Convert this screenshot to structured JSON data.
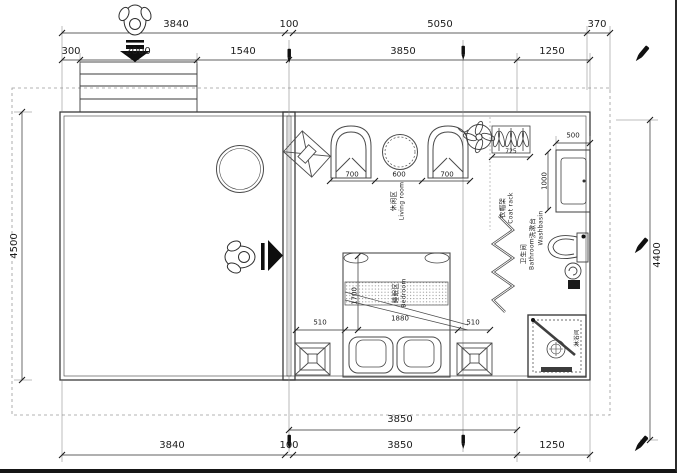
{
  "drawing_title": "guest-room floor plan",
  "dims": {
    "top1": [
      "3840",
      "100",
      "5050",
      "370"
    ],
    "top2": [
      "300",
      "2000",
      "1540",
      "3850",
      "1250"
    ],
    "left": "4500",
    "right": "4400",
    "living": [
      "700",
      "600",
      "700"
    ],
    "coat_rack_w": "725",
    "washbasin_w": "500",
    "washbasin_h": "1000",
    "bed_row": [
      "510",
      "1880",
      "510"
    ],
    "bed_len": "1700",
    "bottom1": "3850",
    "bottom2": [
      "3840",
      "100",
      "3850",
      "1250"
    ]
  },
  "labels": {
    "living": {
      "zh": "休闲区",
      "en": "Living room"
    },
    "bedroom": {
      "zh": "睡眠区",
      "en": "Bedroom"
    },
    "bathroom": {
      "zh": "卫生间",
      "en": "Bathroom"
    },
    "coat_rack": {
      "zh": "衣帽架",
      "en": "Coat rack"
    },
    "washbasin": {
      "zh": "洗漱台",
      "en": "Washbasin"
    },
    "shower": {
      "zh": "淋浴间",
      "en": ""
    }
  },
  "icons": {
    "entry_person": "person-top-view",
    "entry_arrow": "arrow-down",
    "walk_person": "person-top-view",
    "walk_arrow": "arrow-right",
    "ceiling_fan": "fan-circle",
    "markers": "pen-nib"
  },
  "colors": {
    "line": "#3b3b3b",
    "dash": "#9a9a9a",
    "ink": "#111111",
    "bg": "#ffffff"
  }
}
